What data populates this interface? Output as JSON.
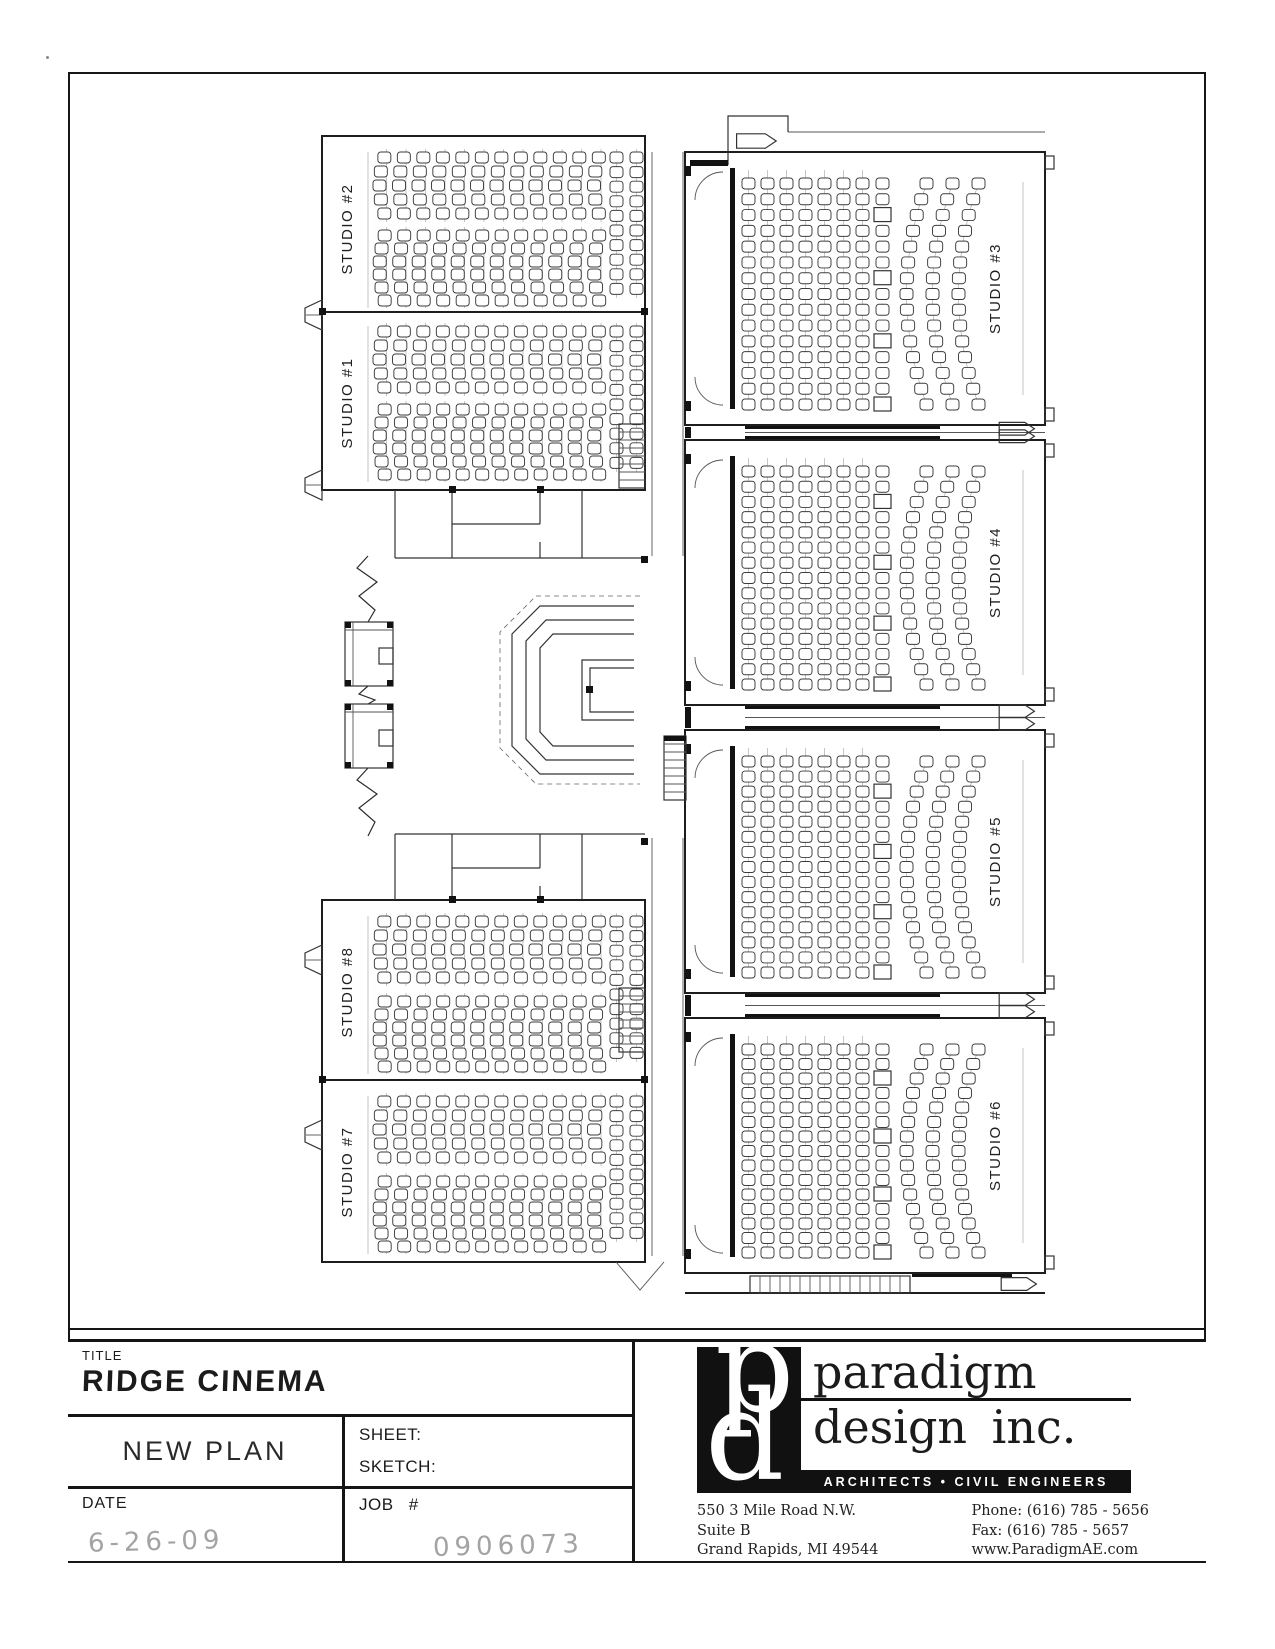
{
  "tb": {
    "title_label": "TITLE",
    "title": "RIDGE CINEMA",
    "plan_name": "NEW PLAN",
    "sheet_label": "SHEET:",
    "sketch_label": "SKETCH:",
    "date_label": "DATE",
    "date_value": "6-26-09",
    "job_label": "JOB #",
    "job_value": "0906073"
  },
  "firm": {
    "monogram_p": "p",
    "monogram_d": "d",
    "name_line1": "paradigm",
    "name_line2": "design inc.",
    "tagline": "ARCHITECTS • CIVIL ENGINEERS",
    "address_line1": "550 3 Mile Road N.W.",
    "address_line2": "Suite B",
    "address_line3": "Grand Rapids, MI  49544",
    "phone": "Phone: (616) 785 - 5656",
    "fax": "Fax: (616) 785 - 5657",
    "website": "www.ParadigmAE.com"
  },
  "colors": {
    "ink": "#1d1d1d",
    "pencil": "#a3a3a3",
    "paper": "#ffffff"
  },
  "plan": {
    "left_studios": [
      {
        "label": "STUDIO #2",
        "label_x": 352,
        "label_y": 229,
        "seat_x": 380,
        "cols": 12,
        "col_step": 19.5,
        "banks": [
          {
            "y": 152,
            "rows": 5,
            "step": 14
          },
          {
            "y": 230,
            "rows": 6,
            "step": 13
          }
        ],
        "extra_x": [
          610,
          630
        ],
        "extra_y": 152,
        "extra_rows": 10,
        "extra_step": 14.6
      },
      {
        "label": "STUDIO #1",
        "label_x": 352,
        "label_y": 403,
        "seat_x": 380,
        "cols": 12,
        "col_step": 19.5,
        "banks": [
          {
            "y": 326,
            "rows": 5,
            "step": 14
          },
          {
            "y": 404,
            "rows": 6,
            "step": 13
          }
        ],
        "extra_x": [
          610,
          630
        ],
        "extra_y": 326,
        "extra_rows": 10,
        "extra_step": 14.6
      },
      {
        "label": "STUDIO #8",
        "label_x": 352,
        "label_y": 992,
        "seat_x": 380,
        "cols": 12,
        "col_step": 19.5,
        "banks": [
          {
            "y": 916,
            "rows": 5,
            "step": 14
          },
          {
            "y": 996,
            "rows": 6,
            "step": 13
          }
        ],
        "extra_x": [
          610,
          630
        ],
        "extra_y": 916,
        "extra_rows": 10,
        "extra_step": 14.6
      },
      {
        "label": "STUDIO #7",
        "label_x": 352,
        "label_y": 1172,
        "seat_x": 380,
        "cols": 12,
        "col_step": 19.5,
        "banks": [
          {
            "y": 1096,
            "rows": 5,
            "step": 14
          },
          {
            "y": 1176,
            "rows": 6,
            "step": 13
          }
        ],
        "extra_x": [
          610,
          630
        ],
        "extra_y": 1096,
        "extra_rows": 10,
        "extra_step": 14.6
      }
    ],
    "right_studios": [
      {
        "label": "STUDIO #3",
        "top": 152,
        "h": 273
      },
      {
        "label": "STUDIO #4",
        "top": 440,
        "h": 265
      },
      {
        "label": "STUDIO #5",
        "top": 730,
        "h": 263
      },
      {
        "label": "STUDIO #6",
        "top": 1018,
        "h": 255
      }
    ],
    "right_metrics": {
      "wall_l": 685,
      "wall_r": 1045,
      "screen_x": 730,
      "col_x": 742,
      "cols": 7,
      "col_step": 19,
      "rows": 15,
      "wc_x": 876,
      "arc_x": [
        900,
        926,
        952
      ],
      "arc_bow": 20,
      "label_x": 1000,
      "leader_x": 1023
    },
    "seat": {
      "w": 13,
      "h": 11
    }
  }
}
